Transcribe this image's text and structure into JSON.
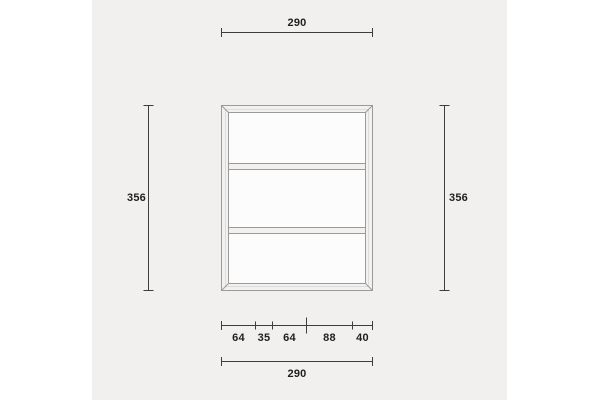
{
  "dimensions": {
    "top_width": "290",
    "left_height": "356",
    "right_height": "356",
    "bottom_segments": [
      "64",
      "35",
      "64",
      "88",
      "40"
    ],
    "bottom_total": "290"
  },
  "colors": {
    "page_background": "#ffffff",
    "panel_background": "#f1f0ef",
    "dimension_line": "#3d3d3d",
    "label_text": "#1f1f1f",
    "frame_stroke": "#9a9a9a",
    "frame_fill": "#f2f1f0",
    "panel_interior": "#fcfcfc"
  }
}
